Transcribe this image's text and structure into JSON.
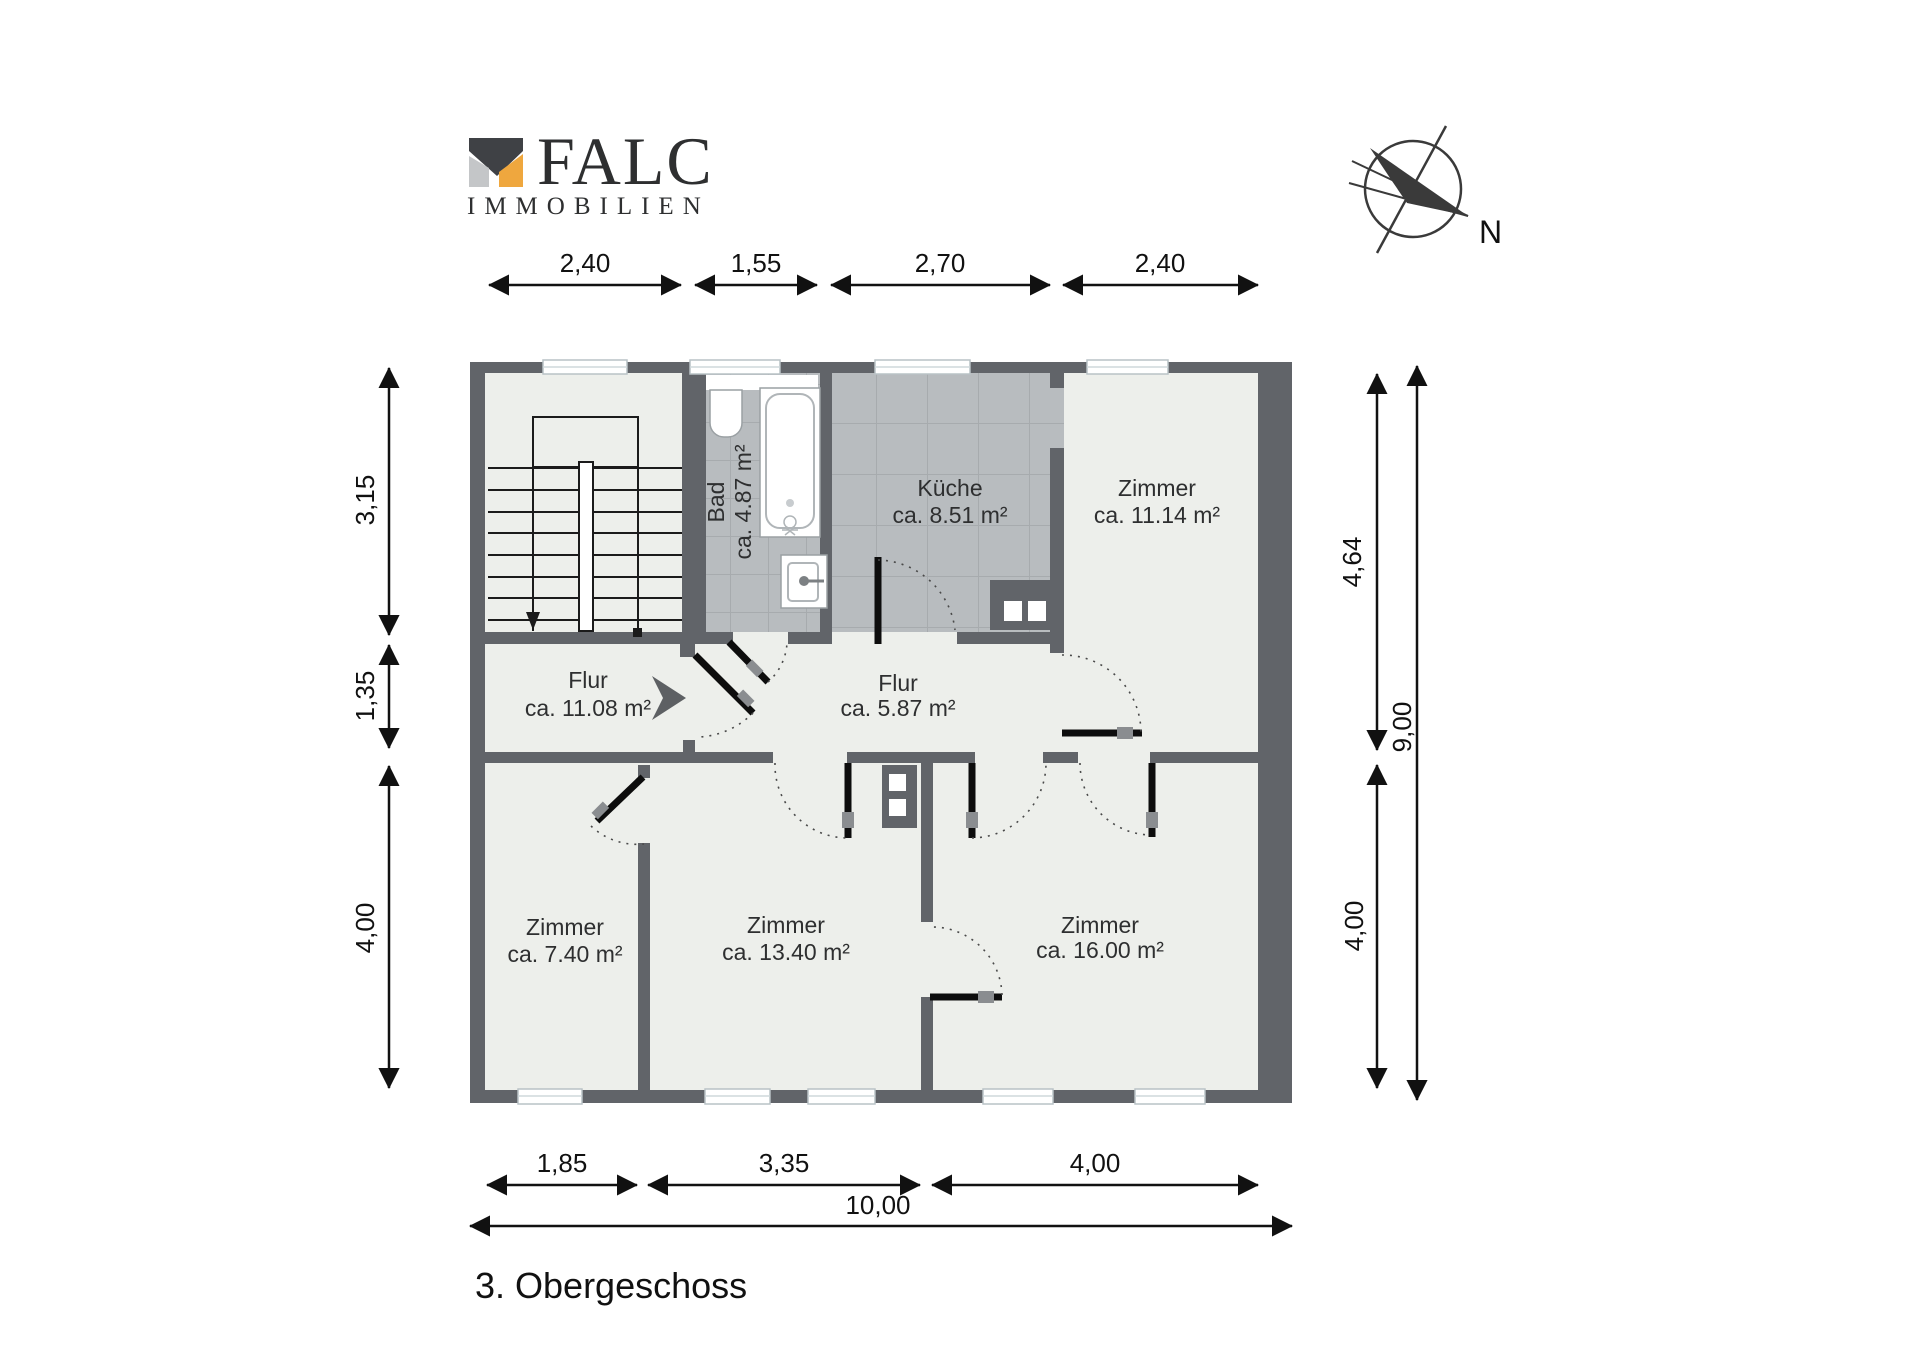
{
  "logo": {
    "brand": "FALC",
    "subtitle": "IMMOBILIEN",
    "colors": {
      "orange": "#efa73e",
      "dark": "#3f4145",
      "gray": "#c4c6c8",
      "sub": "#595b5e"
    }
  },
  "compass": {
    "label": "N"
  },
  "title": "3. Obergeschoss",
  "rooms": {
    "bad": {
      "name": "Bad",
      "area": "ca. 4.87 m²"
    },
    "kueche": {
      "name": "Küche",
      "area": "ca. 8.51 m²"
    },
    "zimmer1": {
      "name": "Zimmer",
      "area": "ca. 11.14 m²"
    },
    "flur1": {
      "name": "Flur",
      "area": "ca. 11.08 m²"
    },
    "flur2": {
      "name": "Flur",
      "area": "ca. 5.87 m²"
    },
    "zimmer2": {
      "name": "Zimmer",
      "area": "ca. 7.40 m²"
    },
    "zimmer3": {
      "name": "Zimmer",
      "area": "ca. 13.40 m²"
    },
    "zimmer4": {
      "name": "Zimmer",
      "area": "ca. 16.00 m²"
    }
  },
  "dimensions": {
    "top": [
      "2,40",
      "1,55",
      "2,70",
      "2,40"
    ],
    "left": [
      "3,15",
      "1,35",
      "4,00"
    ],
    "right": [
      "4,64",
      "4,00",
      "9,00"
    ],
    "bottom": [
      "1,85",
      "3,35",
      "4,00",
      "10,00"
    ]
  },
  "colors": {
    "wall": "#616469",
    "room": "#edefeb",
    "tile": "#b8bcbf",
    "accent": "#efa73e"
  }
}
